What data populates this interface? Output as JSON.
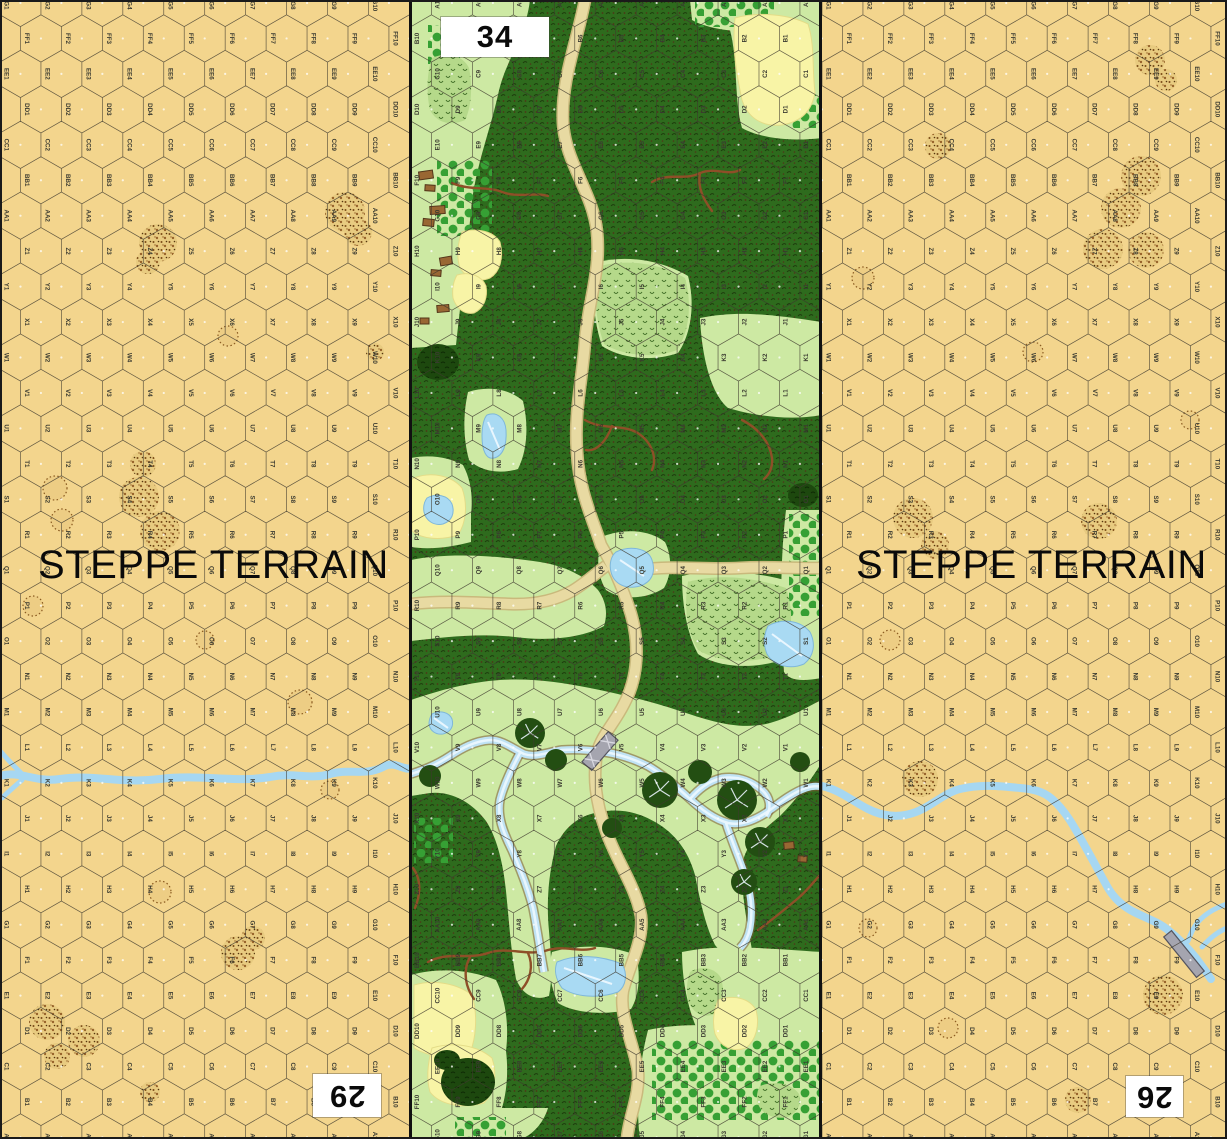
{
  "map": {
    "title": "Hex wargame map — steppe / woods / steppe geomorphic boards",
    "hex_grid": {
      "letters": [
        "A",
        "B",
        "C",
        "D",
        "E",
        "F",
        "G",
        "H",
        "I",
        "J",
        "K",
        "L",
        "M",
        "N",
        "O",
        "P",
        "Q",
        "R",
        "S",
        "T",
        "U",
        "V",
        "W",
        "X",
        "Y",
        "Z",
        "AA",
        "BB",
        "CC",
        "DD",
        "EE",
        "FF",
        "GG"
      ],
      "numbers_per_row": 10,
      "hex_width": 40.94,
      "row_spacing": 35.45,
      "top_row_y": 3
    },
    "colors": {
      "steppe": "#f3d58d",
      "steppe_rough_bg": "#e8cb80",
      "rough_dot1": "#7a4a15",
      "rough_dot2": "#96622a",
      "rough_dot3": "#55360e",
      "hexline": "#3f3a2e",
      "label": "#3a3a30",
      "center_dot": "#ffffff",
      "river_steppe": "#a6d7f2",
      "open": "#cde9a3",
      "woods": "#2e6b1d",
      "woods_tex1": "#1c3a0c",
      "woods_tex2": "#4f3517",
      "brush": "#b5d98a",
      "brush_mark": "#3e6b24",
      "orchard_dot": "#36a034",
      "field": "#f8f4a6",
      "pond": "#a9daf3",
      "pond_edge": "#7fb7d9",
      "ice": "#eef8ff",
      "road": "#e8daa2",
      "road_casing": "#c9b97c",
      "gully": "#8e4f28",
      "river_bank": "#7b5a36",
      "river_fill": "#bfe2f4",
      "river_core": "#edf8ff",
      "bridge": "#a5a5af",
      "bridge_edge": "#55555f",
      "building": "#996733",
      "building_edge": "#53361a",
      "dark_woods": "#1d480e",
      "tree": "#234e12",
      "tree_branch": "#e8f2fa",
      "box_bg": "#ffffff",
      "box_text": "#0a0a0a"
    },
    "boards": [
      {
        "id": "29",
        "number": "29",
        "type": "steppe",
        "x": 0,
        "width": 410,
        "flipped": true,
        "terrain_label": "STEPPE TERRAIN",
        "label_pos": {
          "left": 38,
          "top": 543
        },
        "number_box": {
          "left": 313,
          "top": 1074,
          "width": 68,
          "height": 43
        }
      },
      {
        "id": "34",
        "number": "34",
        "type": "woods",
        "x": 411,
        "width": 410,
        "flipped": false,
        "number_box": {
          "left": 441,
          "top": 17,
          "width": 108,
          "height": 40
        }
      },
      {
        "id": "26",
        "number": "26",
        "type": "steppe",
        "x": 822,
        "width": 405,
        "flipped": true,
        "terrain_label": "STEPPE TERRAIN",
        "label_pos": {
          "left": 856,
          "top": 543
        },
        "number_box": {
          "left": 1126,
          "top": 1076,
          "width": 57,
          "height": 41
        }
      }
    ],
    "steppe_features": {
      "29": {
        "rough": [
          [
            345,
            212,
            20
          ],
          [
            358,
            232,
            14
          ],
          [
            158,
            243,
            19
          ],
          [
            148,
            262,
            12
          ],
          [
            143,
            464,
            13
          ],
          [
            139,
            497,
            20
          ],
          [
            160,
            531,
            20
          ],
          [
            238,
            953,
            17
          ],
          [
            253,
            938,
            12
          ],
          [
            47,
            1022,
            18
          ],
          [
            84,
            1041,
            16
          ],
          [
            57,
            1056,
            13
          ],
          [
            150,
            1092,
            10
          ],
          [
            375,
            352,
            9
          ]
        ],
        "rings": [
          [
            55,
            488,
            12
          ],
          [
            62,
            520,
            11
          ],
          [
            33,
            606,
            10
          ],
          [
            300,
            702,
            12
          ],
          [
            160,
            892,
            11
          ],
          [
            205,
            640,
            9
          ],
          [
            228,
            336,
            10
          ],
          [
            330,
            790,
            9
          ]
        ],
        "river": "M0,776 C20,770 35,783 60,779 C95,774 120,784 160,779 C200,774 235,783 270,777 C295,772 310,780 330,774 C350,768 365,777 385,766 C395,761 404,771 411,768",
        "river_forks": [
          "M1,752 C8,760 14,766 21,773",
          "M2,798 C8,792 15,786 22,780"
        ],
        "bridges": []
      },
      "26": {
        "rough": [
          [
            1141,
            176,
            20
          ],
          [
            1121,
            208,
            20
          ],
          [
            1103,
            249,
            20
          ],
          [
            1146,
            250,
            18
          ],
          [
            938,
            146,
            13
          ],
          [
            1150,
            60,
            15
          ],
          [
            1166,
            80,
            11
          ],
          [
            913,
            518,
            20
          ],
          [
            935,
            545,
            14
          ],
          [
            1099,
            521,
            18
          ],
          [
            920,
            779,
            18
          ],
          [
            1163,
            995,
            20
          ],
          [
            1078,
            1100,
            13
          ]
        ],
        "rings": [
          [
            863,
            278,
            11
          ],
          [
            1033,
            352,
            10
          ],
          [
            948,
            1028,
            10
          ],
          [
            868,
            928,
            9
          ],
          [
            1190,
            420,
            9
          ],
          [
            890,
            640,
            10
          ]
        ],
        "river": "M822,786 C840,790 852,801 868,809 C884,817 900,818 916,812 C932,806 944,793 960,789 C980,784 1000,786 1020,788 C1032,789 1043,791 1052,799 C1066,811 1076,830 1086,848 C1094,862 1100,874 1108,888 C1114,898 1122,906 1134,912 C1146,918 1158,922 1168,930 C1178,938 1188,948 1196,958 C1202,966 1207,973 1211,979",
        "river_forks": [
          "M1227,904 C1215,908 1205,914 1198,922 C1193,928 1190,935 1188,941",
          "M1227,928 C1217,932 1209,939 1202,947"
        ],
        "bridges": [
          {
            "cx": 1184,
            "cy": 954,
            "angle": 51,
            "len": 52,
            "w": 10
          }
        ]
      }
    },
    "center_features": {
      "clearings": [
        "M411,0 L530,0 C525,40 505,60 498,95 C490,130 478,160 472,200 C468,245 462,290 456,345 L411,348 Z",
        "M728,0 L822,0 L822,138 C790,142 760,138 742,128 C734,100 738,60 730,30 Z",
        "M690,0 L782,0 C780,16 772,26 760,31 C733,33 706,28 692,20 Z",
        "M598,262 C630,254 665,262 688,276 C696,306 690,336 678,353 C650,363 618,357 602,346 C592,316 592,288 598,262 Z",
        "M700,318 C740,310 775,315 822,322 L822,415 C790,421 755,416 728,408 C712,395 702,360 700,318 Z",
        "M468,392 C490,385 511,390 523,401 C529,426 527,451 518,469 C498,475 479,470 469,460 C463,438 463,414 468,392 Z",
        "M411,458 C432,454 450,458 463,465 C471,480 473,497 471,514 L471,542 C452,547 430,550 411,547 Z",
        "M411,560 C450,552 500,556 540,562 C565,566 585,576 598,590 C606,601 608,613 604,626 C580,639 545,641 515,637 C480,633 445,637 411,641 Z",
        "M604,536 C625,528 650,530 665,542 C672,556 672,574 664,588 C646,600 620,600 606,590 C596,574 596,552 604,536 Z",
        "M786,510 L822,510 L822,678 C800,682 789,680 784,672 C780,620 780,560 786,510 Z",
        "M682,576 C716,568 758,572 792,582 C800,608 798,638 788,658 C756,670 718,668 698,654 C686,632 682,602 682,576 Z",
        "M411,700 C440,690 470,682 500,680 C530,678 560,682 590,688 C620,694 650,701 680,711 C710,721 740,731 770,723 C795,716 810,705 822,700 L822,762 C810,782 795,801 780,816 C760,833 742,846 742,871 C742,901 748,926 752,950 C740,960 725,958 715,945 C705,925 700,900 695,875 C688,850 675,835 660,825 C640,812 620,808 600,812 C580,815 565,826 556,846 C549,871 546,901 549,931 C551,956 553,976 549,996 C536,1001 523,996 516,979 C511,951 509,921 506,891 C503,861 496,836 486,821 C471,801 450,791 430,793 L411,796 Z",
        "M552,952 C580,944 610,945 636,955 C641,975 639,996 631,1009 C605,1016 574,1013 558,1003 C550,986 548,968 552,952 Z",
        "M411,975 C440,967 470,970 496,980 C506,1000 509,1026 506,1051 C509,1076 506,1101 498,1119 C470,1126 440,1129 411,1126 Z",
        "M411,1108 L548,1108 C543,1124 532,1135 521,1139 L411,1139 Z",
        "M682,952 C720,944 760,948 822,952 L822,1036 L700,1036 C688,1011 682,981 682,952 Z",
        "M648,1030 C690,1021 730,1026 770,1032 L822,1032 L822,1139 L640,1139 C636,1110 638,1068 648,1030 Z"
      ],
      "orchard_areas": [
        "M437,160 L492,160 L492,236 L437,236 Z",
        "M428,25 L460,25 L460,64 L428,64 Z",
        "M695,2 L774,2 L774,27 L695,27 Z",
        "M792,95 L821,95 L821,129 L792,129 Z",
        "M789,514 L821,514 L821,616 L789,616 Z",
        "M414,818 L453,818 L453,863 L414,863 Z",
        "M652,1040 L820,1040 L820,1120 L652,1120 Z",
        "M455,1117 L506,1117 L506,1137 L455,1137 Z"
      ],
      "brush": [
        "M432,58 C448,51 463,56 469,68 C473,88 471,108 465,120 C450,127 436,122 430,110 C426,92 427,72 432,58 Z",
        "M600,266 C630,258 663,265 685,278 C693,306 688,334 677,350 C651,360 620,354 604,344 C594,316 594,290 600,266 Z",
        "M688,582 C720,573 755,578 786,588 C794,610 792,636 784,652 C755,665 720,663 698,650 C686,630 684,605 688,582 Z",
        "M690,972 C702,965 715,968 721,978 C725,992 723,1006 715,1014 C702,1019 692,1012 688,1000 C686,990 687,980 690,972 Z",
        "M760,1086 C776,1080 792,1084 799,1094 C802,1104 798,1112 788,1117 C774,1120 762,1114 758,1104 C756,1097 757,1091 760,1086 Z"
      ],
      "fields": [
        "M735,18 C760,11 790,15 808,24 C815,45 812,70 815,92 C812,112 800,122 782,125 C762,127 748,118 742,100 C736,72 732,45 735,18 Z",
        "M462,232 C478,227 494,232 500,242 C504,258 500,272 490,278 C478,283 466,278 460,268 C456,256 458,242 462,232 Z",
        "M457,275 C470,271 482,276 486,286 C488,298 484,308 474,313 C464,315 456,308 453,298 C452,290 453,282 457,275 Z",
        "M414,478 C432,471 452,476 462,488 C468,505 466,523 458,535 C440,541 422,539 412,531 L411,480 Z",
        "M414,985 C435,979 458,984 472,995 C478,1015 476,1038 470,1053 C450,1059 428,1057 414,1048 Z",
        "M432,1048 C455,1041 478,1046 492,1058 C498,1075 494,1093 484,1103 C462,1109 440,1105 430,1092 C426,1078 428,1062 432,1048 Z",
        "M718,1000 C735,994 750,999 756,1010 C760,1025 756,1040 746,1048 C732,1053 720,1046 715,1034 C712,1022 714,1010 718,1000 Z"
      ],
      "dark_blobs": [
        [
          803,
          495,
          15,
          12
        ],
        [
          438,
          362,
          21,
          18
        ],
        [
          468,
          1082,
          27,
          24
        ],
        [
          447,
          1060,
          13,
          10
        ]
      ],
      "gullies": [
        "M452,183 C470,191 488,186 502,192 C518,198 535,192 548,196",
        "M652,182 C668,172 685,181 700,173 C715,167 728,176 740,170",
        "M700,173 C697,188 704,200 712,211",
        "M585,420 C602,430 620,424 636,432",
        "M636,432 C650,440 658,456 652,470",
        "M612,426 C606,442 596,452 586,450",
        "M742,420 C758,428 770,442 772,458 C773,466 770,474 764,479",
        "M428,962 C448,951 468,960 488,953 C508,946 528,957 548,950 C565,945 580,953 595,948",
        "M470,957 C462,972 466,988 474,999",
        "M528,953 C534,966 530,980 522,989",
        "M758,930 C772,920 784,910 796,900 C806,892 812,884 819,876",
        "M413,868 C422,880 420,896 415,908"
      ],
      "roads": [
        "M585,0 C577,42 561,80 563,122 C565,163 593,192 597,232 C601,272 588,302 585,342 C582,382 574,412 577,452 C579,492 594,522 601,545 C610,560 622,585 631,614 C640,645 638,678 624,704 C614,724 601,736 597,753 C593,776 595,800 606,831 C617,862 636,887 641,916 C644,941 629,966 623,991 C619,1016 633,1041 638,1071 C640,1096 629,1116 627,1139",
        "M411,604 C445,600 478,603 510,604 C536,605 556,600 572,591 C584,584 595,574 606,566",
        "M636,570 C680,565 700,570 740,568 C770,566 796,569 822,568"
      ],
      "river_strands": [
        "M411,774 C424,770 438,764 450,756 C462,748 475,741 490,740 C502,740 512,748 524,754 C536,758 548,752 562,750 C576,749 590,750 604,752 C618,754 634,759 648,766 C662,774 676,786 690,799 C702,810 714,819 728,823 C742,826 756,820 770,810 C782,801 794,792 806,788 C812,786 818,786 822,787",
        "M690,799 C698,790 708,781 722,778 C736,776 750,780 762,790 C770,797 772,808 766,816",
        "M726,823 C732,842 740,860 746,878 C751,895 753,912 750,928 C748,938 744,944 740,948",
        "M520,753 C512,768 504,784 500,800 C497,816 503,832 512,850 C520,868 528,888 533,908 C537,928 540,950 544,972"
      ],
      "ponds": [
        "M616,552 C630,545 648,548 652,560 C656,572 652,582 640,586 C626,590 614,584 611,572 C609,564 611,556 616,552 Z",
        "M768,626 C782,618 800,620 810,632 C816,644 814,656 804,664 C790,670 774,666 767,654 C763,644 764,634 768,626 Z",
        "M487,415 C497,411 505,418 506,430 C507,445 503,456 494,458 C486,460 482,450 482,436 C482,426 484,418 487,415 Z",
        "M427,498 C436,493 448,495 452,504 C455,513 452,521 443,524 C434,526 426,521 424,512 C423,506 424,502 427,498 Z",
        "M557,962 C575,954 600,955 622,964 C628,974 626,986 618,992 C598,999 575,997 562,988 C555,978 554,970 557,962 Z",
        "M432,714 C440,710 449,712 452,719 C454,726 451,732 443,734 C436,735 430,731 429,724 C429,720 430,717 432,714 Z"
      ],
      "ice_streaks": [
        "M620,560 L644,576",
        "M772,634 L802,656",
        "M488,422 L500,450",
        "M564,968 L612,984",
        "M434,718 L448,728"
      ],
      "trees": [
        [
          530,
          733,
          15
        ],
        [
          556,
          760,
          11
        ],
        [
          660,
          790,
          18
        ],
        [
          700,
          772,
          12
        ],
        [
          737,
          800,
          20
        ],
        [
          760,
          842,
          15
        ],
        [
          744,
          882,
          13
        ],
        [
          800,
          762,
          10
        ],
        [
          430,
          776,
          11
        ],
        [
          612,
          828,
          10
        ]
      ],
      "buildings": [
        [
          419,
          171,
          14,
          8,
          -8
        ],
        [
          425,
          185,
          10,
          6,
          4
        ],
        [
          430,
          206,
          15,
          8,
          -4
        ],
        [
          423,
          219,
          11,
          7,
          6
        ],
        [
          440,
          257,
          12,
          8,
          -10
        ],
        [
          431,
          270,
          10,
          6,
          5
        ],
        [
          437,
          305,
          12,
          7,
          -5
        ],
        [
          420,
          318,
          9,
          6,
          0
        ],
        [
          784,
          842,
          10,
          7,
          -6
        ],
        [
          798,
          856,
          9,
          6,
          4
        ]
      ],
      "bridges": [
        {
          "cx": 600,
          "cy": 751,
          "angle": -49,
          "len": 40,
          "w": 13,
          "truss": true
        }
      ]
    }
  }
}
